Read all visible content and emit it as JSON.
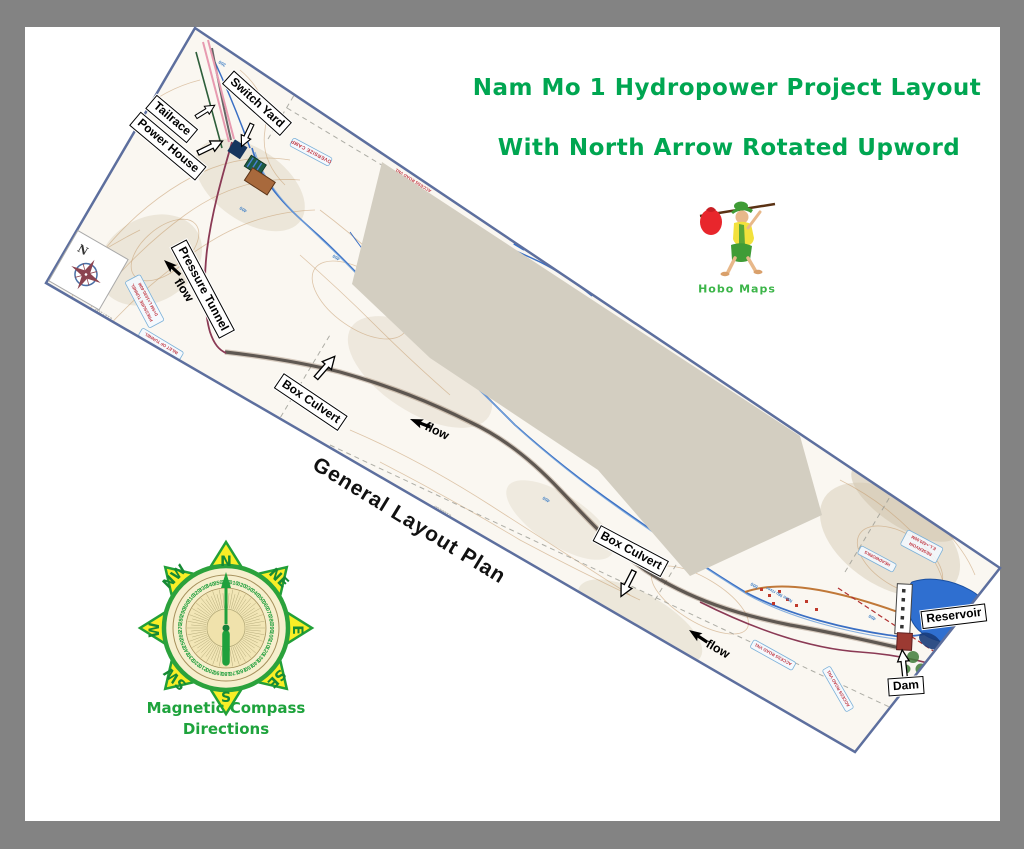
{
  "page": {
    "background": "#838383",
    "paper": "#ffffff"
  },
  "title": {
    "line1": "Nam Mo 1 Hydropower Project Layout",
    "line2": "With North Arrow Rotated Upword",
    "color": "#00a651"
  },
  "logo": {
    "caption": "Hobo Maps",
    "color": "#3cb549"
  },
  "compass_rose": {
    "caption_line1": "Magnetic Compass",
    "caption_line2": "Directions",
    "caption_color": "#1ea33c",
    "cardinals": [
      "N",
      "NE",
      "E",
      "SE",
      "S",
      "SW",
      "W",
      "NW"
    ],
    "dial_numbers": [
      "010",
      "020",
      "030",
      "040",
      "050",
      "060",
      "070",
      "080",
      "090",
      "100",
      "110",
      "120",
      "130",
      "140",
      "150",
      "160",
      "170",
      "180",
      "190",
      "200",
      "210",
      "220",
      "230",
      "240",
      "250",
      "260",
      "270",
      "280",
      "290",
      "300",
      "310",
      "320",
      "330",
      "340",
      "350",
      "360"
    ]
  },
  "map": {
    "border_color": "#5d6f9e",
    "north_letter": "N",
    "plan_label": "General Layout Plan",
    "flow_labels": [
      "flow",
      "flow",
      "flow"
    ],
    "callouts": {
      "switch_yard": {
        "label": "Switch Yard"
      },
      "tailrace": {
        "label": "Tailrace"
      },
      "power_house": {
        "label": "Power House"
      },
      "pressure_tunnel": {
        "label": "Pressure Tunnel"
      },
      "box_culvert_1": {
        "label": "Box Culvert"
      },
      "box_culvert_2": {
        "label": "Box Culvert"
      },
      "reservoir": {
        "label": "Reservoir"
      },
      "dam": {
        "label": "Dam"
      }
    },
    "texts": {
      "oversize_camp": "OVERSIZE CAMP",
      "access_road_top": "ACCESS ROAD VN1",
      "access_road_bottom": "ACCESS ROAD VN1",
      "access_road_corner": "ACCESS ROAD VN1",
      "pressure_tunnel_line1": "PRESSURE TUNNEL",
      "pressure_tunnel_line2": "D=5M L=1030.40M",
      "inlet_of_tunnel": "INLET OF TUNNEL",
      "headworks": "HEADWORKS",
      "reservoir_line1": "RESERVOIR",
      "reservoir_line2": "E.L.+420.00M",
      "river_name": "Nam Mo river",
      "river_name2": "Nam Mo river",
      "grid_2127100": "2127100",
      "grid_2128100": "2128100",
      "grid_2125100": "2125100",
      "grid_376000": "376000",
      "elevations": [
        "350",
        "400",
        "450",
        "400",
        "450",
        "500",
        "400",
        "500",
        "450"
      ]
    }
  }
}
